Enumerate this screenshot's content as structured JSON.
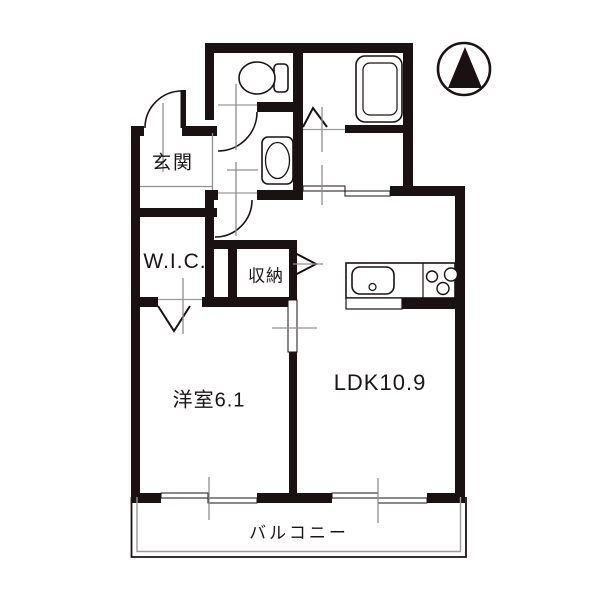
{
  "floorplan": {
    "rooms": {
      "genkan": {
        "label": "玄関"
      },
      "wic": {
        "label": "W.I.C."
      },
      "shunou": {
        "label": "収納"
      },
      "youshitsu": {
        "label": "洋室6.1"
      },
      "ldk": {
        "label": "LDK10.9"
      },
      "balcony": {
        "label": "バルコニー"
      }
    },
    "fixtures": {
      "toilet": "toilet-icon",
      "bathtub": "bathtub-icon",
      "washbasin": "washbasin-icon",
      "kitchen_sink": "kitchen-sink-icon",
      "stove": "stove-burners-icon"
    },
    "compass": {
      "icon": "north-arrow-icon",
      "direction": "N"
    },
    "colors": {
      "wall": "#1a1212",
      "line": "#1a1212",
      "guide": "#8f8f8f",
      "background": "#ffffff"
    }
  }
}
